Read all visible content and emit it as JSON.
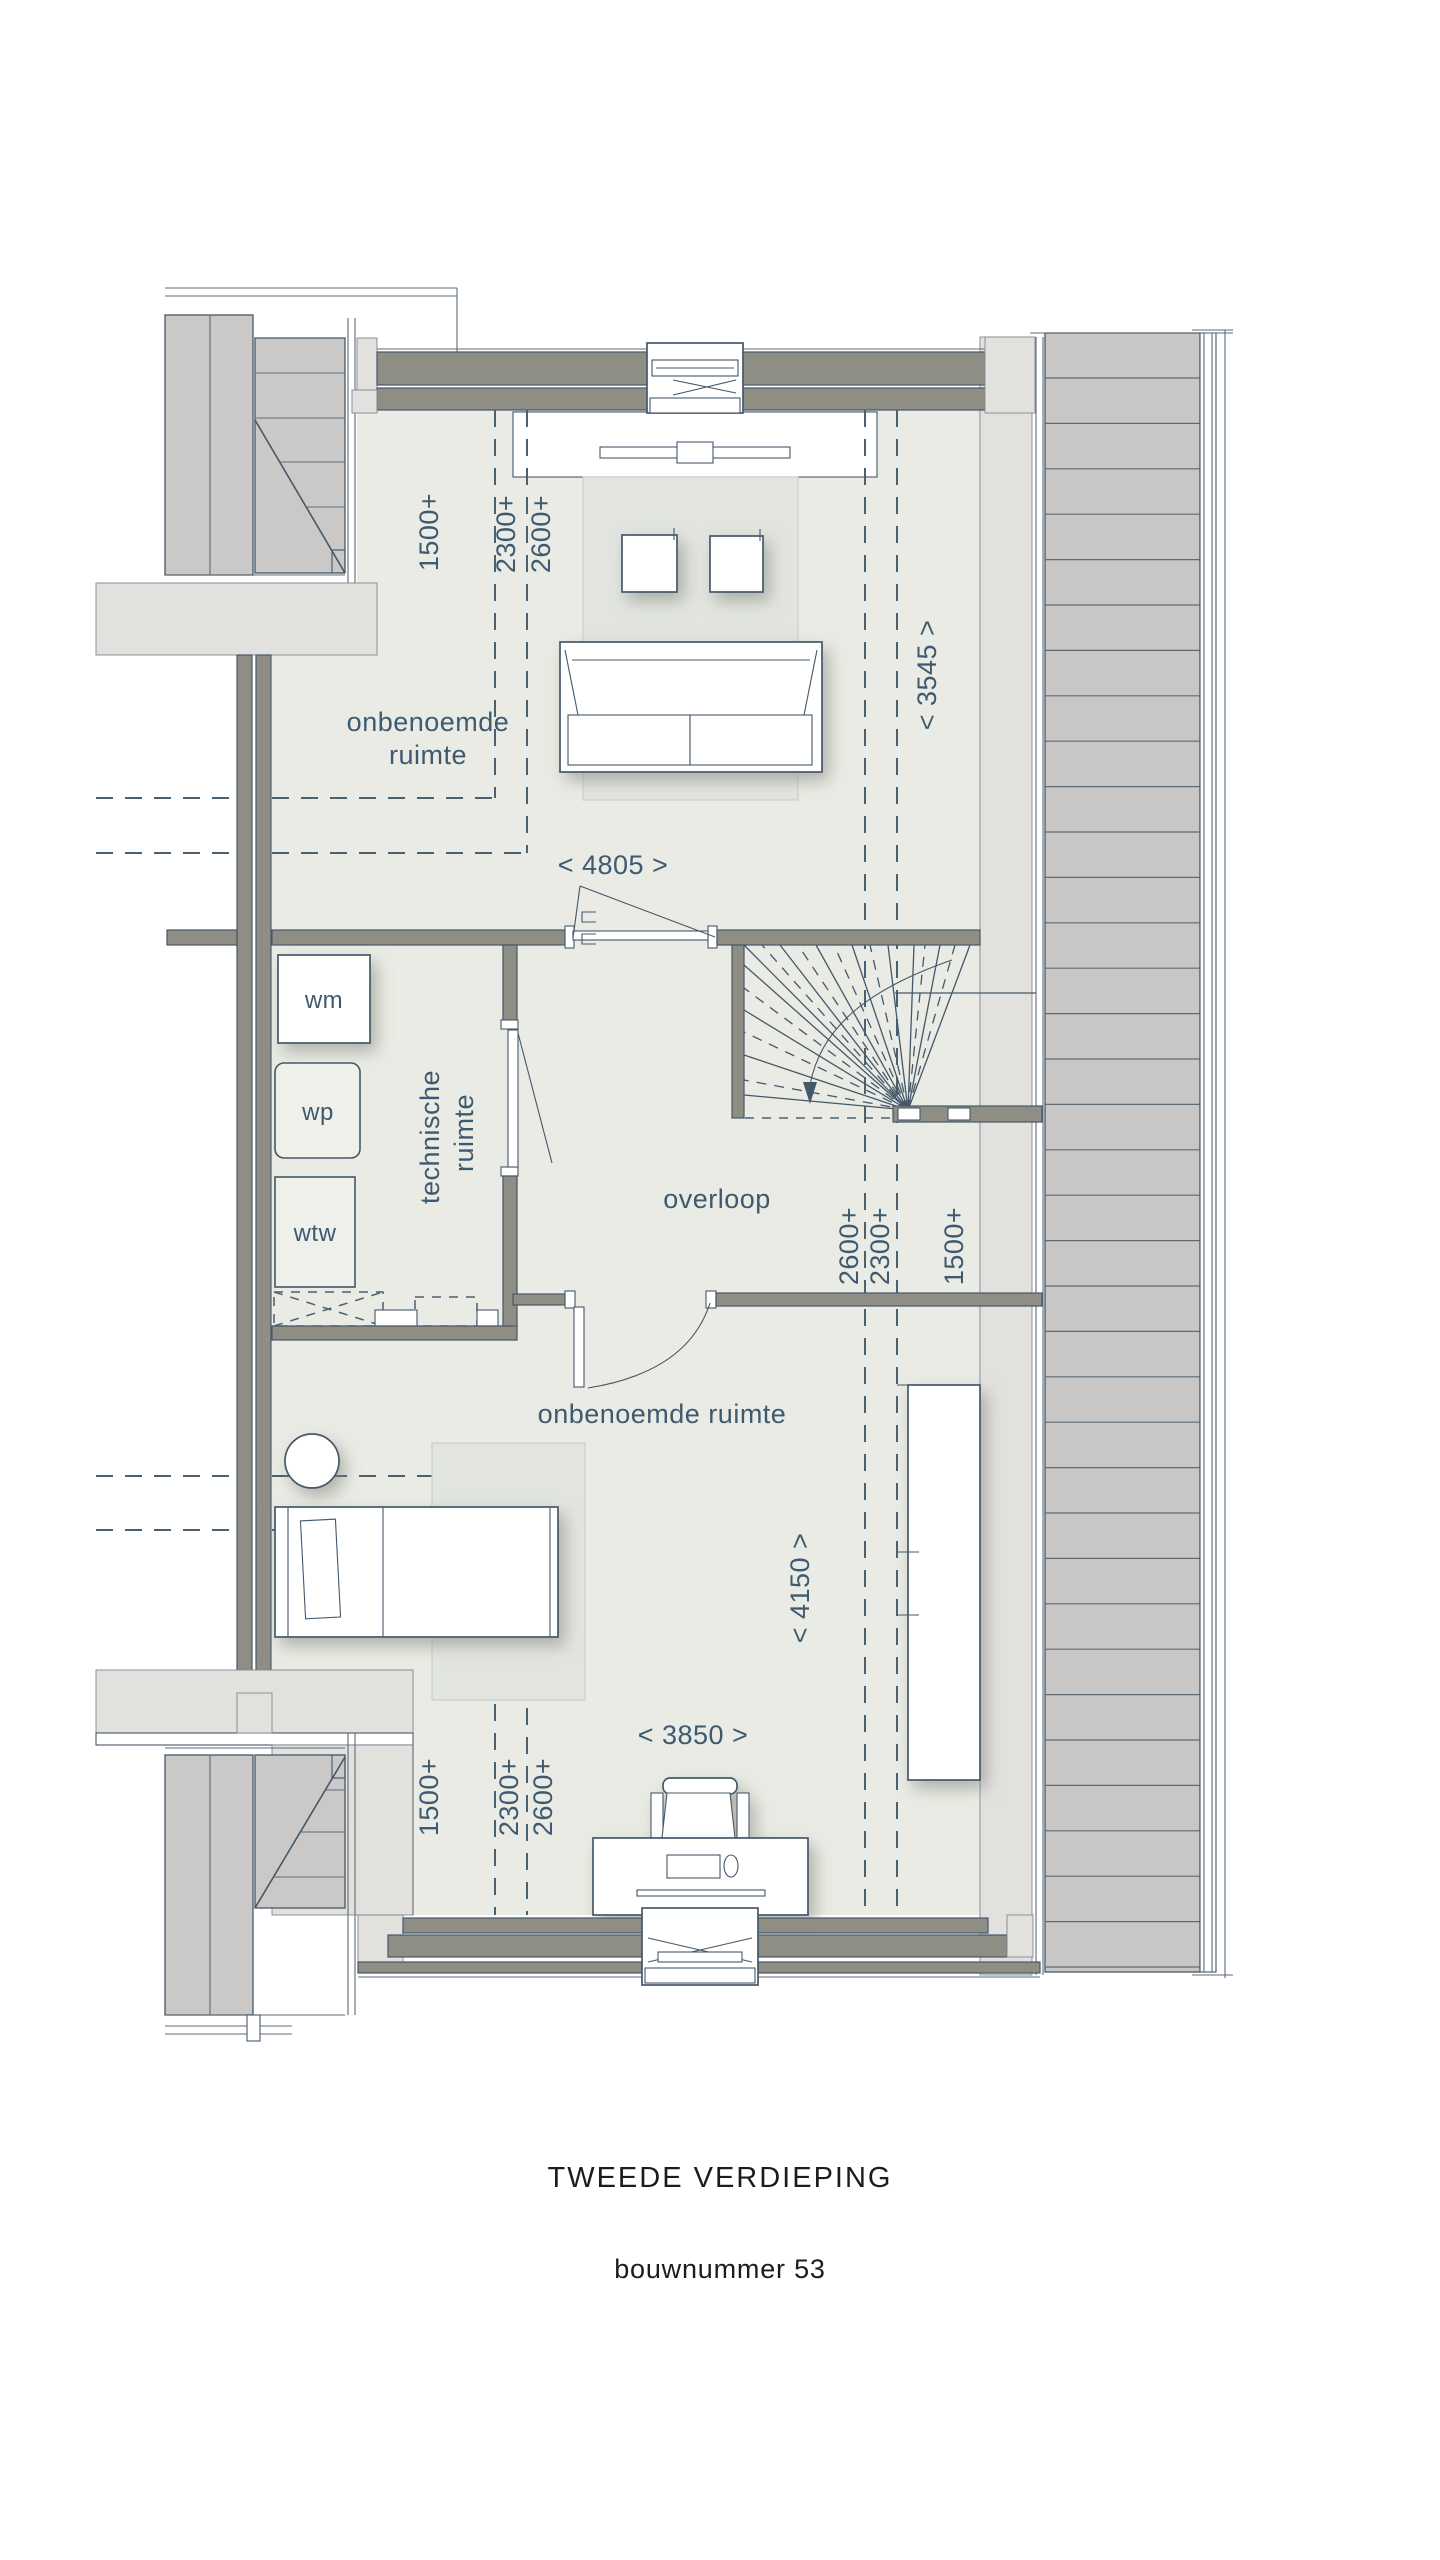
{
  "plan": {
    "title": "TWEEDE VERDIEPING",
    "subtitle": "bouwnummer 53",
    "rooms": {
      "top_room": {
        "label_line1": "onbenoemde",
        "label_line2": "ruimte"
      },
      "technical_room": {
        "label_line1": "technische",
        "label_line2": "ruimte"
      },
      "landing": {
        "label": "overloop"
      },
      "bottom_room": {
        "label": "onbenoemde ruimte"
      }
    },
    "appliances": {
      "washing_machine": "wm",
      "heat_pump": "wp",
      "heat_recovery_unit": "wtw"
    },
    "dimensions": {
      "top_room_width": "< 4805 >",
      "top_room_depth": "< 3545 >",
      "bottom_room_width": "< 3850 >",
      "bottom_room_depth": "< 4150 >",
      "top_height_labels": [
        "1500+",
        "2300+",
        "2600+"
      ],
      "landing_height_labels": [
        "2600+",
        "2300+",
        "1500+"
      ],
      "bottom_height_labels": [
        "1500+",
        "2300+",
        "2600+"
      ]
    },
    "colors": {
      "label_text": "#3e5a70",
      "title_text": "#1c1c1c",
      "line": "#44586a",
      "wall_fill": "#8f8e84",
      "floor_fill": "#e9ebe4",
      "roof_fill": "#c8c7c5",
      "neighbour_roof_fill": "#cac9c7",
      "light_strip_fill": "#e3e1de",
      "rug_fill": "#e2e4df"
    }
  }
}
